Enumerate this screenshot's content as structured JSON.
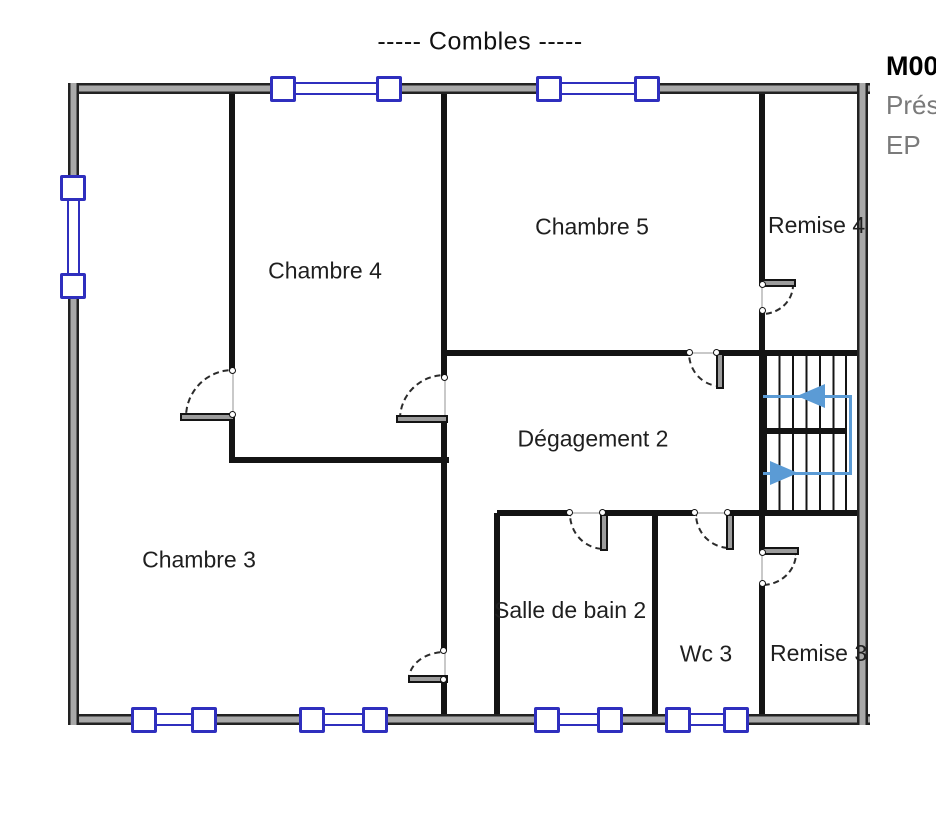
{
  "title": {
    "text": "-----  Combles  -----"
  },
  "annotation": {
    "line1": "M00",
    "line2": "Prés",
    "line3": "EP"
  },
  "rooms": [
    {
      "id": "chambre-4",
      "label": "Chambre 4"
    },
    {
      "id": "chambre-5",
      "label": "Chambre 5"
    },
    {
      "id": "remise-4",
      "label": "Remise 4"
    },
    {
      "id": "degagement-2",
      "label": "Dégagement 2"
    },
    {
      "id": "chambre-3",
      "label": "Chambre 3"
    },
    {
      "id": "salle-de-bain-2",
      "label": "Salle de bain 2"
    },
    {
      "id": "wc-3",
      "label": "Wc 3"
    },
    {
      "id": "remise-3",
      "label": "Remise 3"
    }
  ],
  "colors": {
    "wall": "#141414",
    "outer_wall_core": "#a9a9a9",
    "window_frame": "#2f2fbe",
    "stair_path": "#5b9bd5",
    "label_text": "#1f1f1f",
    "annotation_muted": "#7a7a7a"
  },
  "icons": {
    "stair_up_arrow": "arrow-left",
    "stair_entry_arrow": "arrow-right"
  }
}
